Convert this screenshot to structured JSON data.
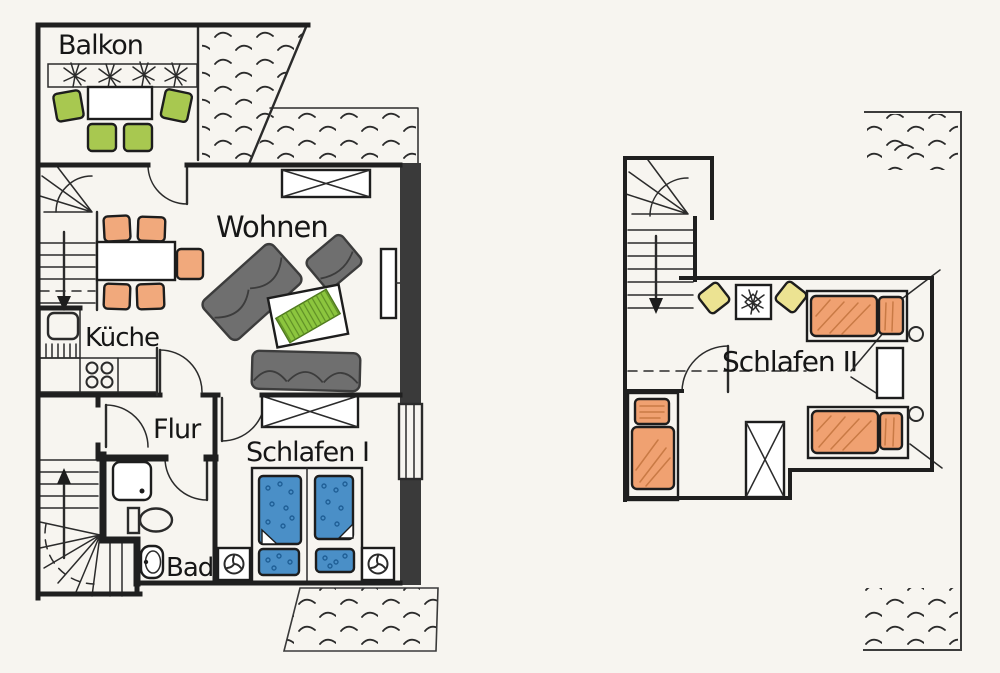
{
  "labels": {
    "balkon": "Balkon",
    "wohnen": "Wohnen",
    "kueche": "Küche",
    "flur": "Flur",
    "bad": "Bad",
    "schlafen1": "Schlafen I",
    "schlafen2": "Schlafen II"
  },
  "colors": {
    "paper": "#f7f5f0",
    "wall": "#1f1f1f",
    "wall_dark": "#3a3a3a",
    "line": "#2b2b2b",
    "chair_orange": "#f1a97c",
    "bed_orange": "#f0a171",
    "hatch_orange": "#c97a45",
    "cushion_green": "#a8c850",
    "rug_green": "#8cc63e",
    "duvet_blue": "#4a8fc7",
    "dot_blue": "#1f5f96",
    "cushion_yellow": "#ece392",
    "sofa_gray": "#6f6f6f",
    "sofa_dark": "#3c3c3c"
  }
}
